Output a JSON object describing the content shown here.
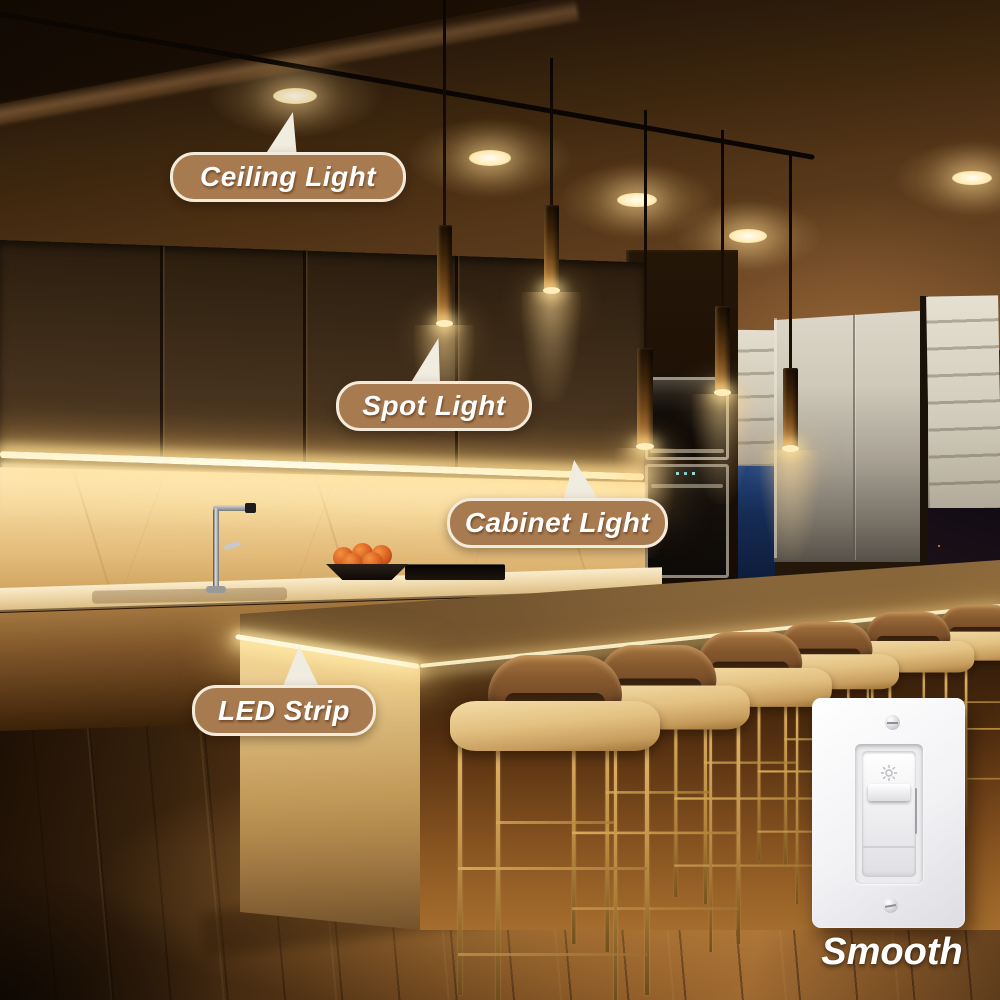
{
  "callouts": [
    {
      "id": "ceiling-light",
      "label": "Ceiling Light"
    },
    {
      "id": "spot-light",
      "label": "Spot Light"
    },
    {
      "id": "cabinet-light",
      "label": "Cabinet Light"
    },
    {
      "id": "led-strip",
      "label": "LED Strip"
    }
  ],
  "dimmer": {
    "caption": "Smooth",
    "icon": "brightness-icon"
  },
  "colors": {
    "callout_bg": "#a87a50",
    "callout_border": "#f3ead9",
    "callout_text": "#ffffff",
    "caption_text": "#ffffff",
    "led_glow": "#fff7d6",
    "warm_light": "#ffd98a",
    "ceiling_dark": "#2a1a0c",
    "gold_frame": "#c8973f",
    "night_city_light": "#ff8040"
  }
}
